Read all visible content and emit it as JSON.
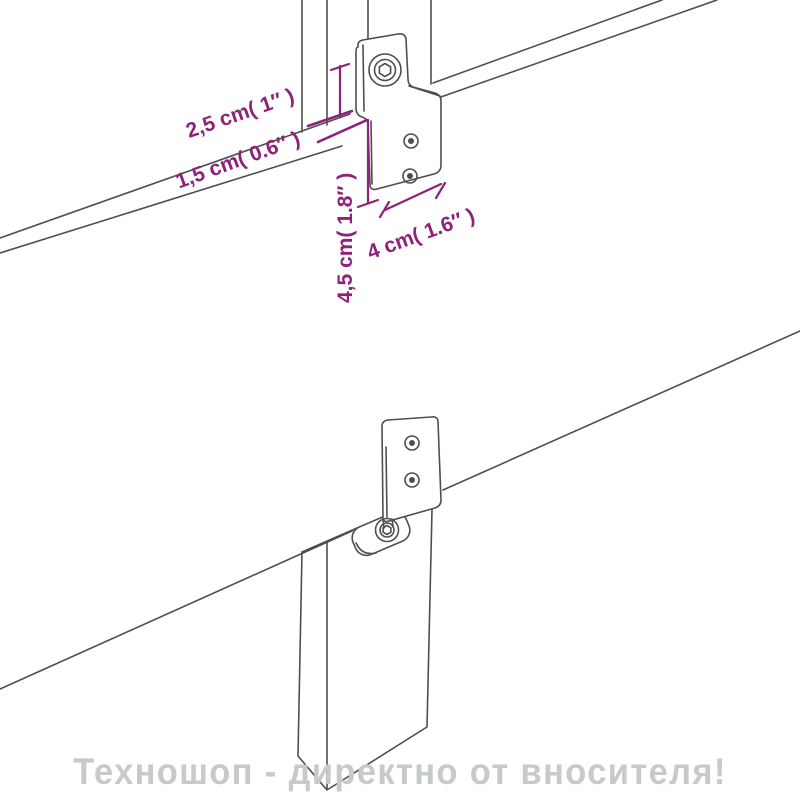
{
  "image": {
    "description": "assembly-diagram of headboard mounting bracket with dimensions",
    "background": "#ffffff"
  },
  "colors": {
    "dimension_text": "#8e2179",
    "drawing_lines": "#4e4e4e",
    "watermark_text": "#c6cac8"
  },
  "dimensions": {
    "top_offset": "2,5 cm( 1″ )",
    "panel_lip": "1,5 cm( 0.6″ )",
    "bracket_height": "4,5 cm( 1.8″ )",
    "bracket_width": "4 cm( 1.6″ )"
  },
  "watermark": {
    "text": "Техношоп - директно от вносителя!"
  }
}
